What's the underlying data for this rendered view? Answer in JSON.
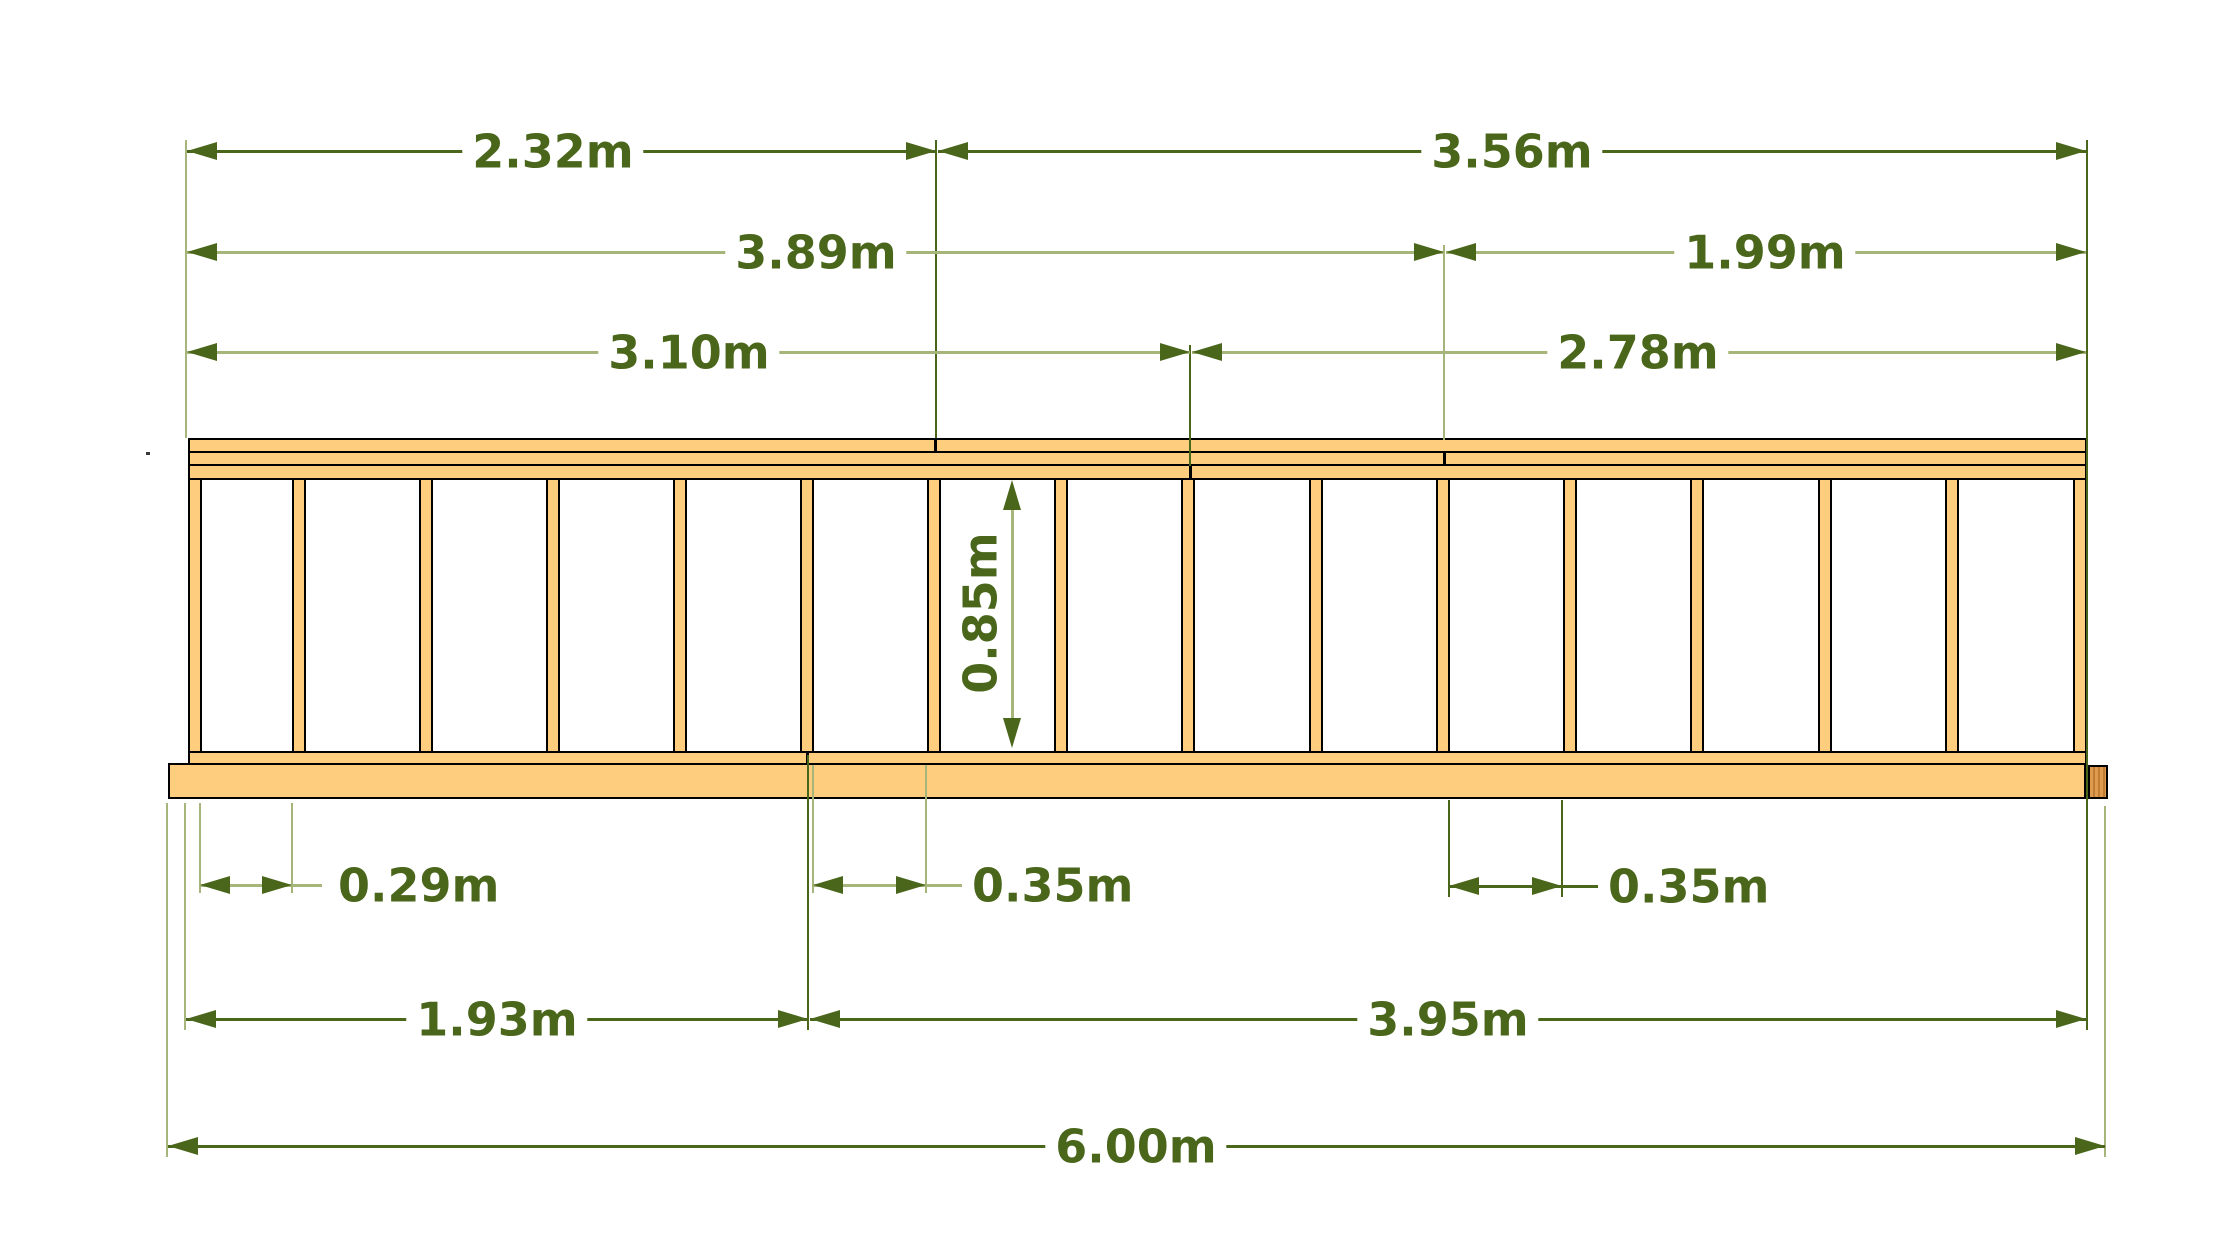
{
  "diagram": {
    "type": "timber-frame-elevation-drawing",
    "unit": "m",
    "labels": {
      "span_top_left": "2.32m",
      "span_top_right": "3.56m",
      "span_mid_left": "3.89m",
      "span_mid_right": "1.99m",
      "span_lower_left": "3.10m",
      "span_lower_right": "2.78m",
      "frame_height": "0.85m",
      "bay_first": "0.29m",
      "bay_middle": "0.35m",
      "bay_right": "0.35m",
      "bottom_left_section": "1.93m",
      "bottom_right_section": "3.95m",
      "total_length": "6.00m"
    },
    "values_m": {
      "span_top_left": 2.32,
      "span_top_right": 3.56,
      "span_mid_left": 3.89,
      "span_mid_right": 1.99,
      "span_lower_left": 3.1,
      "span_lower_right": 2.78,
      "frame_height": 0.85,
      "bay_first": 0.29,
      "bay_middle": 0.35,
      "bay_right": 0.35,
      "bottom_left_section": 1.93,
      "bottom_right_section": 3.95,
      "total_length": 6.0
    },
    "structure": {
      "stud_count": 16,
      "top_rail_board_count": 3,
      "bottom_rail_count": 1,
      "has_bottom_skid_plate": true,
      "skid_end_block_right": true,
      "rail_joints": [
        "top board joint",
        "middle board joint",
        "lower board joint",
        "bottom rail joint"
      ]
    },
    "colors": {
      "wood": "#FECD7D",
      "wood_end_grain": "#DE9A4E",
      "outline": "#000000",
      "dimension_dark": "#4A661B",
      "dimension_light": "#A6B57A",
      "background": "#FFFFFF"
    }
  }
}
